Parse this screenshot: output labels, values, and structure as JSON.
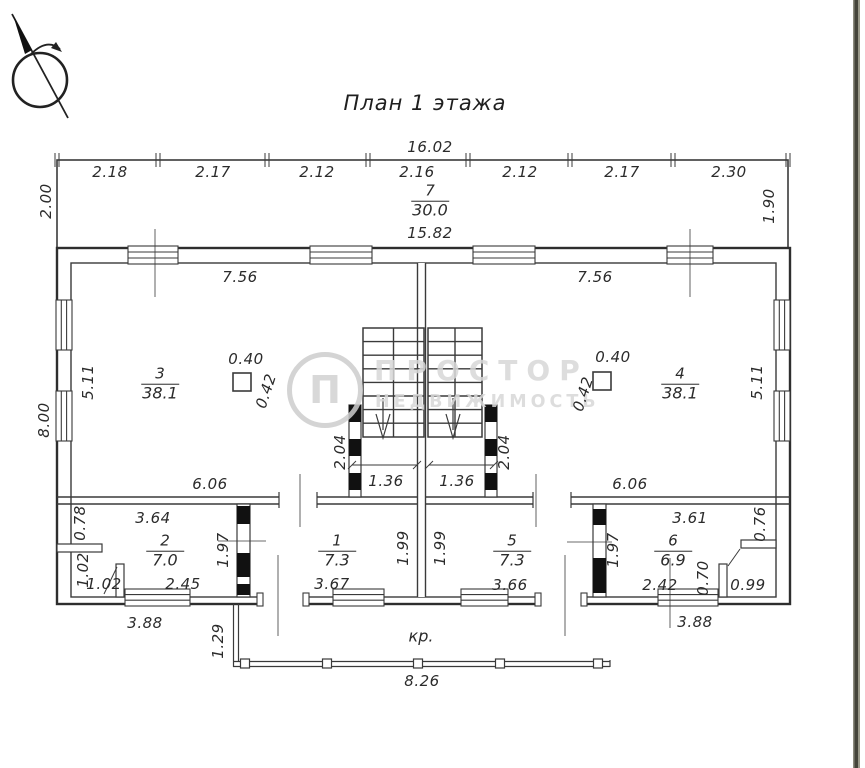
{
  "title": "План 1 этажа",
  "porch": {
    "label": "кр."
  },
  "watermark": {
    "logo_letter": "П",
    "line1": "ПРОСТОР",
    "line2": "НЕДВИЖИМОСТЬ"
  },
  "colors": {
    "line": "#3a3a3a",
    "outer_wall": "#2e2e2e",
    "text": "#2b2b2b",
    "watermark": "#d8d8d8",
    "border_strip": "#45443a",
    "background": "#ffffff"
  },
  "rooms": [
    {
      "number": "7",
      "area": "30.0",
      "x": 430,
      "y": 201
    },
    {
      "number": "3",
      "area": "38.1",
      "x": 160,
      "y": 384
    },
    {
      "number": "4",
      "area": "38.1",
      "x": 680,
      "y": 384
    },
    {
      "number": "2",
      "area": "7.0",
      "x": 165,
      "y": 551
    },
    {
      "number": "1",
      "area": "7.3",
      "x": 337,
      "y": 551
    },
    {
      "number": "5",
      "area": "7.3",
      "x": 512,
      "y": 551
    },
    {
      "number": "6",
      "area": "6.9",
      "x": 673,
      "y": 551
    }
  ],
  "dimensions": [
    {
      "t": "16.02",
      "x": 430,
      "y": 147
    },
    {
      "t": "2.18",
      "x": 110,
      "y": 172
    },
    {
      "t": "2.17",
      "x": 213,
      "y": 172
    },
    {
      "t": "2.12",
      "x": 317,
      "y": 172
    },
    {
      "t": "2.16",
      "x": 417,
      "y": 172
    },
    {
      "t": "2.12",
      "x": 520,
      "y": 172
    },
    {
      "t": "2.17",
      "x": 622,
      "y": 172
    },
    {
      "t": "2.30",
      "x": 729,
      "y": 172
    },
    {
      "t": "2.00",
      "x": 46,
      "y": 201,
      "r": -90
    },
    {
      "t": "1.90",
      "x": 769,
      "y": 206,
      "r": -90
    },
    {
      "t": "15.82",
      "x": 430,
      "y": 233
    },
    {
      "t": "7.56",
      "x": 240,
      "y": 277
    },
    {
      "t": "7.56",
      "x": 595,
      "y": 277
    },
    {
      "t": "5.11",
      "x": 88,
      "y": 382,
      "r": -90
    },
    {
      "t": "5.11",
      "x": 757,
      "y": 382,
      "r": -90
    },
    {
      "t": "8.00",
      "x": 44,
      "y": 420,
      "r": -90
    },
    {
      "t": "0.40",
      "x": 246,
      "y": 359
    },
    {
      "t": "0.42",
      "x": 266,
      "y": 391,
      "r": -72
    },
    {
      "t": "0.40",
      "x": 613,
      "y": 357
    },
    {
      "t": "0.42",
      "x": 583,
      "y": 394,
      "r": -72
    },
    {
      "t": "2.04",
      "x": 340,
      "y": 452,
      "r": -90
    },
    {
      "t": "2.04",
      "x": 504,
      "y": 452,
      "r": -90
    },
    {
      "t": "1.36",
      "x": 386,
      "y": 481
    },
    {
      "t": "1.36",
      "x": 457,
      "y": 481
    },
    {
      "t": "6.06",
      "x": 210,
      "y": 484
    },
    {
      "t": "6.06",
      "x": 630,
      "y": 484
    },
    {
      "t": "3.64",
      "x": 153,
      "y": 518
    },
    {
      "t": "0.78",
      "x": 80,
      "y": 523,
      "r": -90
    },
    {
      "t": "1.97",
      "x": 223,
      "y": 550,
      "r": -90
    },
    {
      "t": "1.02",
      "x": 83,
      "y": 570,
      "r": -90
    },
    {
      "t": "1.02",
      "x": 104,
      "y": 584
    },
    {
      "t": "2.45",
      "x": 183,
      "y": 584
    },
    {
      "t": "1.99",
      "x": 403,
      "y": 548,
      "r": -90
    },
    {
      "t": "3.67",
      "x": 332,
      "y": 584
    },
    {
      "t": "1.99",
      "x": 440,
      "y": 548,
      "r": -90
    },
    {
      "t": "3.66",
      "x": 510,
      "y": 585
    },
    {
      "t": "1.97",
      "x": 613,
      "y": 550,
      "r": -90
    },
    {
      "t": "3.61",
      "x": 690,
      "y": 518
    },
    {
      "t": "0.76",
      "x": 760,
      "y": 524,
      "r": -90
    },
    {
      "t": "2.42",
      "x": 660,
      "y": 585
    },
    {
      "t": "0.70",
      "x": 703,
      "y": 578,
      "r": -90
    },
    {
      "t": "0.99",
      "x": 748,
      "y": 585
    },
    {
      "t": "3.88",
      "x": 145,
      "y": 623
    },
    {
      "t": "3.88",
      "x": 695,
      "y": 622
    },
    {
      "t": "1.29",
      "x": 218,
      "y": 641,
      "r": -90
    },
    {
      "t": "8.26",
      "x": 422,
      "y": 681
    }
  ]
}
